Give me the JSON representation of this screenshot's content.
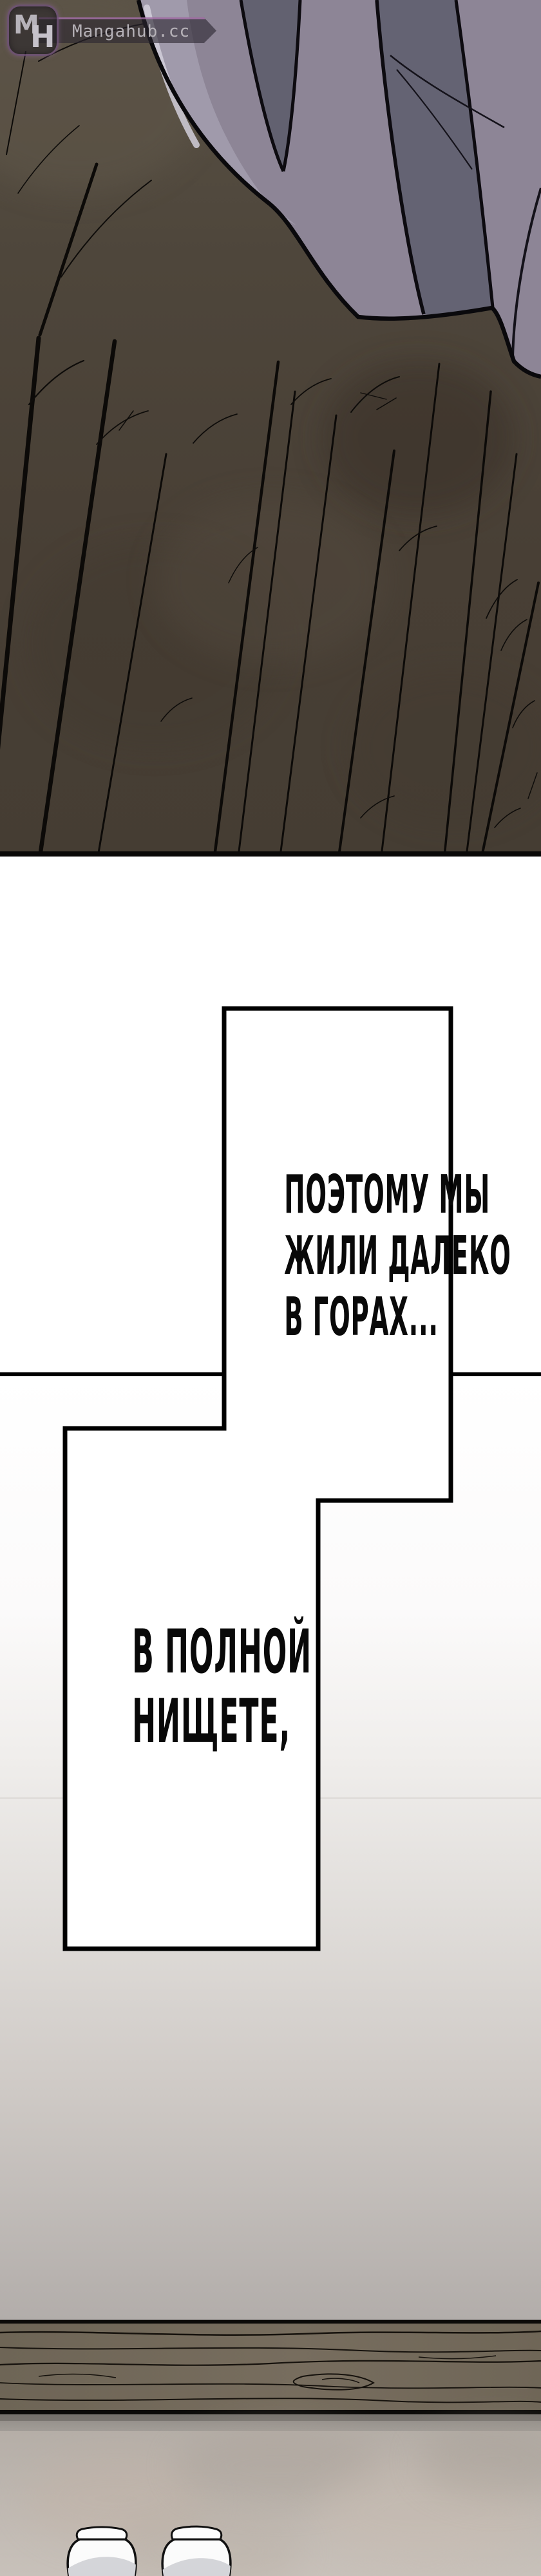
{
  "watermark": {
    "logo_text_m": "M",
    "logo_text_h": "H",
    "site_name": "Mangahub.cc"
  },
  "speech": {
    "bubble1": {
      "line1": "ПОЭТОМУ МЫ",
      "line2": "ЖИЛИ ДАЛЕКО",
      "line3": "В ГОРАХ..."
    },
    "bubble2": {
      "line1": "В ПОЛНОЙ",
      "line2": "НИЩЕТЕ,"
    }
  },
  "colors": {
    "outline": "#000000",
    "bubble_fill": "#ffffff",
    "cloth_light": "#8d8596",
    "cloth_dark_fold": "#636274",
    "cloth_highlight": "#d2cfda",
    "floor_dark": "#4e463b",
    "wall_top": "#ffffff",
    "wall_bottom": "#b2adaa",
    "beam_wood": "#6e6556",
    "lower_floor": "#c0b8b1",
    "watermark_accent": "#c482c8",
    "watermark_text": "#b6b2b8"
  }
}
